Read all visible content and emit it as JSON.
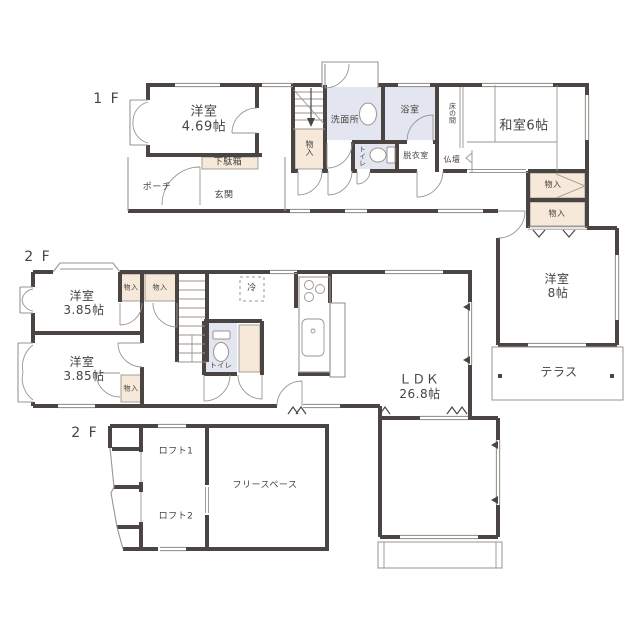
{
  "plan": {
    "colors": {
      "wall": "#4a4543",
      "line": "#9a958f",
      "storage": "#f6e9d9",
      "wet": "#e3e6f1",
      "text": "#474340",
      "bg": "#ffffff"
    },
    "labels": {
      "floor1": "1 F",
      "floor2": "2 F",
      "floor2_loft": "2 F",
      "room_469_name": "洋室",
      "room_469_size": "4.69帖",
      "shoe_cabinet": "下駄箱",
      "porch": "ポーチ",
      "entrance": "玄関",
      "storage": "物入",
      "washroom": "洗面所",
      "toilet": "トイレ",
      "bathroom": "浴室",
      "dressing_room": "脱衣室",
      "tokonoma": "床の間",
      "altar": "仏壇",
      "japanese_room": "和室6帖",
      "room_8_name": "洋室",
      "room_8_size": "8帖",
      "terrace": "テラス",
      "room_385_name": "洋室",
      "room_385_size": "3.85帖",
      "refrigerator": "冷",
      "ldk_name": "ＬＤＫ",
      "ldk_size": "26.8帖",
      "loft1": "ロフト1",
      "loft2": "ロフト2",
      "free_space": "フリースペース"
    }
  }
}
